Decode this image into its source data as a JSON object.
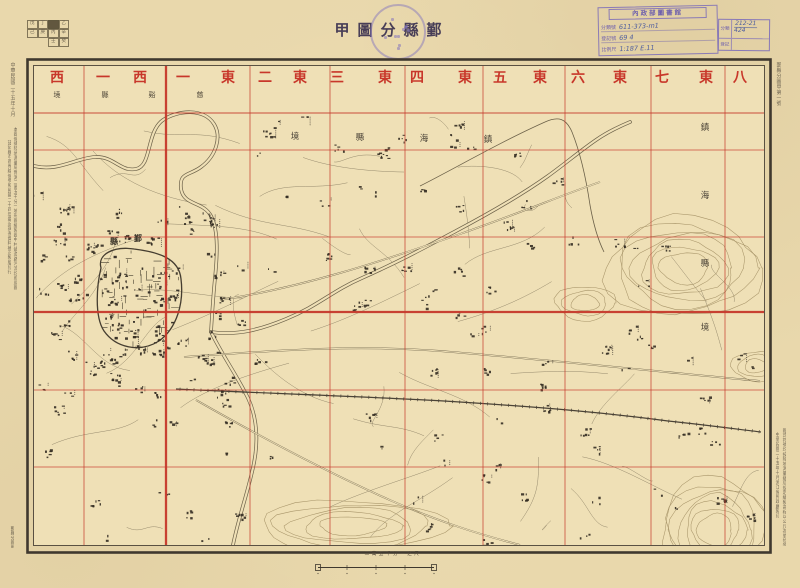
{
  "palette": {
    "paper": "#e9d8ac",
    "map_paper": "#efe0b6",
    "red": "#c6392b",
    "ink": "#4a4236",
    "frame": "#3f382e",
    "linework": "#6b6048",
    "contour": "#a28e63",
    "village": "#332c22",
    "purple": "#7d6fb8",
    "handwriting": "#4c5c9e",
    "title_ink": "#483e57"
  },
  "header": {
    "title": "鄞縣分圖甲",
    "title_display_chars": [
      "甲",
      "圖",
      "分",
      "縣",
      "鄞"
    ]
  },
  "index_grid": {
    "rows": [
      [
        "戊",
        "丁",
        "甲",
        "乙"
      ],
      [
        "己",
        "庚",
        "丙",
        "辛"
      ],
      [
        "",
        "",
        "壬",
        "癸"
      ]
    ],
    "dark_cell": [
      0,
      2
    ]
  },
  "stamps": {
    "library": {
      "header": "內政部圖書館",
      "rows": [
        {
          "label": "分類號",
          "value": "611-373-m1"
        },
        {
          "label": "登記號",
          "value": "69 4"
        },
        {
          "label": "比例尺",
          "value": "1:187  E.11"
        }
      ]
    },
    "catalog": {
      "rows": [
        {
          "label": "分類",
          "value": "212-21",
          "value2": "424"
        },
        {
          "label": "登記",
          "value": "",
          "value2": ""
        }
      ]
    }
  },
  "band": {
    "red_chars": [
      {
        "ch": "西",
        "x": 57
      },
      {
        "ch": "一",
        "x": 103
      },
      {
        "ch": "西",
        "x": 140
      },
      {
        "ch": "一",
        "x": 183
      },
      {
        "ch": "東",
        "x": 228
      },
      {
        "ch": "二",
        "x": 265
      },
      {
        "ch": "東",
        "x": 300
      },
      {
        "ch": "三",
        "x": 337
      },
      {
        "ch": "東",
        "x": 385
      },
      {
        "ch": "四",
        "x": 417
      },
      {
        "ch": "東",
        "x": 465
      },
      {
        "ch": "五",
        "x": 500
      },
      {
        "ch": "東",
        "x": 540
      },
      {
        "ch": "六",
        "x": 578
      },
      {
        "ch": "東",
        "x": 620
      },
      {
        "ch": "七",
        "x": 662
      },
      {
        "ch": "東",
        "x": 706
      },
      {
        "ch": "八",
        "x": 740
      }
    ],
    "column_names_rtl": [
      "東八",
      "東七",
      "東六",
      "東五",
      "東四",
      "東三",
      "東二",
      "東一",
      "西一",
      "西二"
    ],
    "small_chars": [
      {
        "ch": "境",
        "x": 57
      },
      {
        "ch": "縣",
        "x": 105
      },
      {
        "ch": "谿",
        "x": 152
      },
      {
        "ch": "慈",
        "x": 200
      }
    ],
    "small_text_rtl": "慈谿縣境"
  },
  "grid_lines": {
    "vertical": [
      84,
      166,
      250,
      330,
      405,
      483,
      565,
      651,
      725
    ],
    "heavy_vertical": 166,
    "horizontal": [
      113,
      150,
      237,
      312,
      390,
      467
    ],
    "heavy_horizontal": 312
  },
  "boundary_labels": {
    "zhenhai_top": {
      "text_rtl": "鎮海縣境",
      "chars": [
        {
          "ch": "境",
          "x": 295,
          "y": 137
        },
        {
          "ch": "縣",
          "x": 360,
          "y": 138
        },
        {
          "ch": "海",
          "x": 424,
          "y": 139
        },
        {
          "ch": "鎮",
          "x": 488,
          "y": 140
        }
      ]
    },
    "zhenhai_right": {
      "text": "鎮海縣境",
      "chars": [
        {
          "ch": "鎮",
          "x": 705,
          "y": 128
        },
        {
          "ch": "海",
          "x": 705,
          "y": 196
        },
        {
          "ch": "縣",
          "x": 705,
          "y": 264
        },
        {
          "ch": "境",
          "x": 705,
          "y": 328
        }
      ]
    },
    "city": {
      "text_rtl": "鄞縣",
      "chars": [
        {
          "ch": "縣",
          "x": 114,
          "y": 242
        },
        {
          "ch": "鄞",
          "x": 138,
          "y": 239
        }
      ]
    }
  },
  "margin_notes": {
    "left_top": "中華民國二十五年十月",
    "left_long_1": "本圖係據陸地測量局實測二萬五千分一地形圖縮製圖中村鎮道路河流均照原圖",
    "left_long_2": "註記縣市區界線係參照民國二十四年最近調查資料補正製版印行",
    "right_top": "鄞縣分圖甲第一號",
    "right_bottom_1": "圖式符號均按陸地測量總局規定繪製高程以公尺為單位等高線間隔二十公尺",
    "right_bottom_2": "中華民國二十五年十月浙江省民政廳製印",
    "bottom_left": "鄞縣分圖甲"
  },
  "scale_bar": {
    "label": "二萬五千分一之尺"
  },
  "map_features": {
    "rivers": [
      "M34,166 C58,172 76,158 95,157 C114,156 120,172 136,169 C152,166 146,132 163,120 C178,110 204,108 214,124 C222,137 216,156 201,167 C189,176 179,172 181,189 C184,206 203,201 211,216 C219,231 217,258 215,278 C213,298 212,316 211,332",
      "M211,332 C238,336 262,329 286,319 C318,306 332,291 362,278 C398,262 422,249 456,231 C488,214 520,196 548,176 C566,163 580,151 596,140 C606,133 618,127 630,122",
      "M212,334 C224,358 236,374 248,398 C259,422 258,448 252,472 C246,498 238,520 233,545"
    ],
    "bank": "M420,186 C452,170 500,142 545,122 C558,116 566,118 572,132 C580,152 586,178 590,205 C593,222 597,238 604,252",
    "roads": [
      "M184,357 C280,350 362,344 452,352 C560,361 662,372 760,381",
      "M196,400 C252,432 322,470 392,501 C440,522 478,534 520,545",
      "M220,300 C300,288 380,262 460,234 C520,213 560,196 600,182"
    ],
    "railway": "M176,389 C260,393 352,396 444,401 C540,407 600,412 668,421 C706,425 736,429 761,432",
    "city_wall": "M101,268 C97,254 114,246 134,249 C158,252 179,258 181,279 C184,303 177,328 159,341 C140,353 116,348 104,331 C94,316 97,284 101,268 Z",
    "hills": [
      {
        "cx": 684,
        "cy": 268,
        "rx": 78,
        "ry": 50,
        "n": 7
      },
      {
        "cx": 715,
        "cy": 530,
        "rx": 55,
        "ry": 52,
        "n": 7
      },
      {
        "cx": 352,
        "cy": 526,
        "rx": 92,
        "ry": 26,
        "n": 5
      },
      {
        "cx": 585,
        "cy": 303,
        "rx": 30,
        "ry": 17,
        "n": 3
      },
      {
        "cx": 756,
        "cy": 366,
        "rx": 24,
        "ry": 15,
        "n": 3
      }
    ]
  }
}
